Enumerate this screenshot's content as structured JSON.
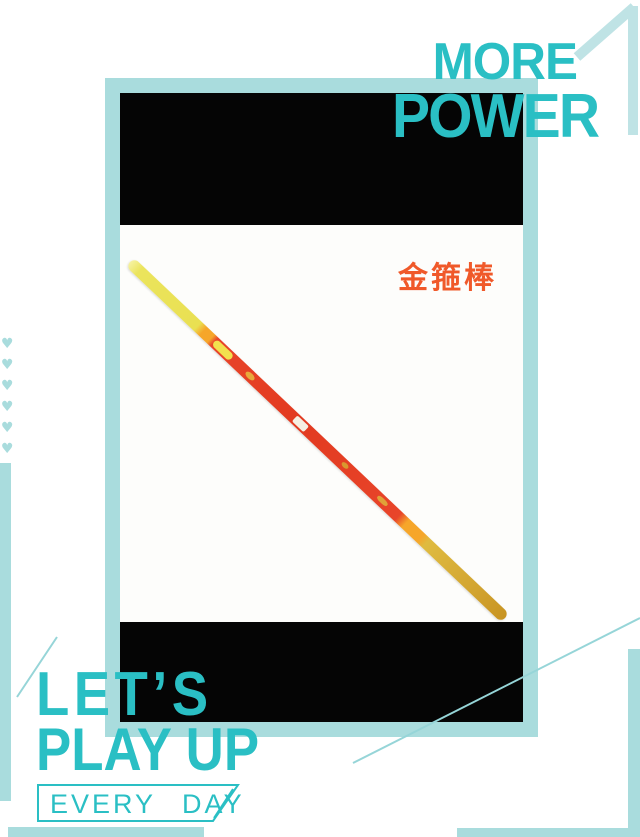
{
  "poster": {
    "header": {
      "line1": "MORE",
      "line2": "POWER"
    },
    "hero": {
      "product_label": "金箍棒"
    },
    "footer": {
      "line1": "LET’S",
      "line2": "PLAY UP",
      "tagline": "EVERY DAY"
    }
  },
  "icons": {
    "heart": "♥"
  },
  "colors": {
    "accent": "#2abfc4",
    "accent-light": "#a9dcdd",
    "accent-pale": "#bfe3e5",
    "line": "#96d5d8",
    "orange": "#f0592a",
    "panel-black": "#050505",
    "card-bg": "#fdfdfb",
    "page-bg": "#ffffff"
  }
}
